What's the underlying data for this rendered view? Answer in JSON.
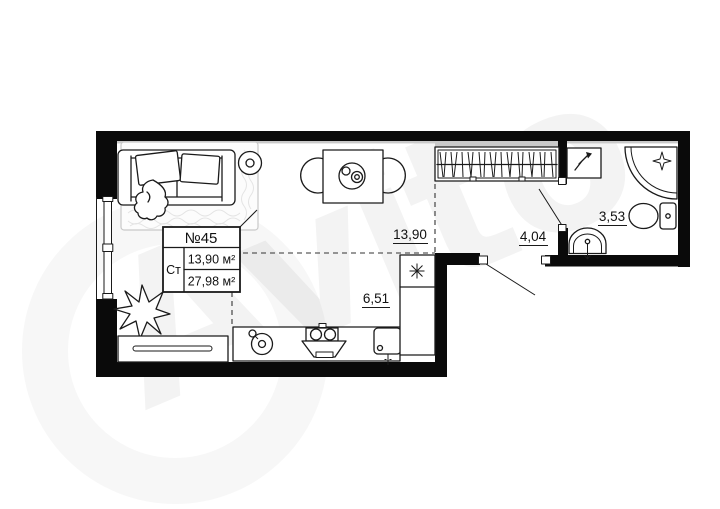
{
  "watermark": {
    "text": "Avito"
  },
  "unit_card": {
    "number": "№45",
    "type_label": "Ст",
    "living_area": "13,90 м²",
    "total_area": "27,98 м²"
  },
  "areas": {
    "main_room": "13,90",
    "kitchen": "6,51",
    "hallway": "4,04",
    "bathroom": "3,53"
  },
  "colors": {
    "walls": "#0a0a0a",
    "lines": "#1a1a1a",
    "watermark_tint": "rgba(20,20,20,0.05)"
  }
}
